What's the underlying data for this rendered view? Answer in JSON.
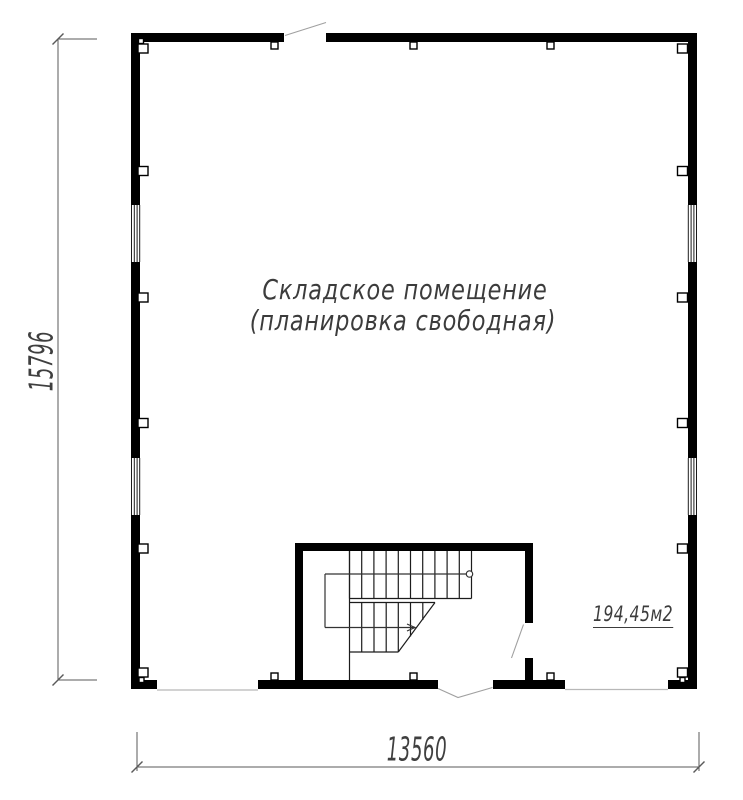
{
  "plan": {
    "room_label": {
      "line1": "Складское помещение",
      "line2": "(планировка свободная)"
    },
    "area_label": "194,45м2",
    "dimension_left": "15796",
    "dimension_bottom": "13560",
    "colors": {
      "wall": "#000000",
      "stair_line": "#1c1c1c",
      "walk_line": "#333333",
      "dimension_line": "#5a5a5a",
      "door_swing_line": "#a0a0a0",
      "threshold_line": "#b8b8b8",
      "text": "#3c3c3c",
      "background": "#ffffff"
    }
  }
}
